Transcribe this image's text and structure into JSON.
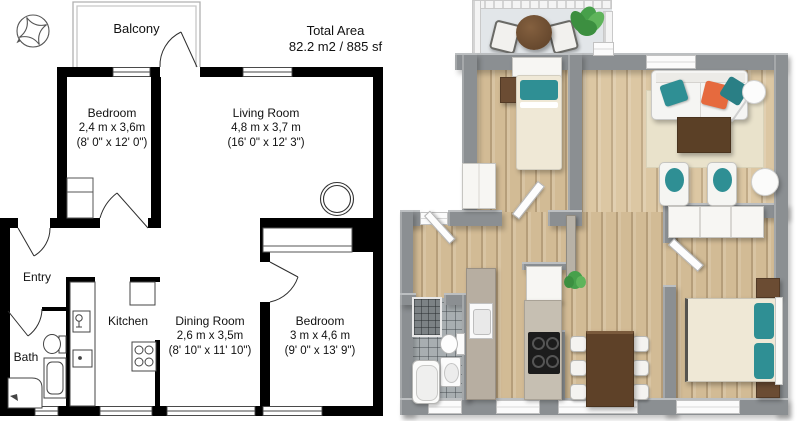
{
  "plan2d": {
    "balcony_label": "Balcony",
    "total_area_label": "Total Area",
    "total_area_value": "82.2 m2 / 885 sf",
    "rooms": {
      "bedroom1": {
        "name": "Bedroom",
        "metric": "2,4 m x 3,6m",
        "imperial": "(8' 0\" x 12' 0\")"
      },
      "living": {
        "name": "Living Room",
        "metric": "4,8 m x 3,7 m",
        "imperial": "(16' 0\" x 12' 3\")"
      },
      "entry": {
        "name": "Entry"
      },
      "bath": {
        "name": "Bath"
      },
      "kitchen": {
        "name": "Kitchen"
      },
      "dining": {
        "name": "Dining Room",
        "metric": "2,6 m x 3,5m",
        "imperial": "(8' 10\" x 11' 10\")"
      },
      "bedroom2": {
        "name": "Bedroom",
        "metric": "3 m x 4,6 m",
        "imperial": "(9' 0\" x 13' 9\")"
      }
    },
    "icons": {
      "compass": "compass-rose"
    },
    "colors": {
      "wall": "#000000",
      "background": "#ffffff",
      "balcony_outline": "#b0b0b0"
    }
  },
  "plan3d": {
    "colors": {
      "wall": "#8b8f92",
      "floor_wood": "#d2bb95",
      "floor_balcony": "#e2e6e9",
      "floor_bath": "#a8aeb1",
      "accent_teal": "#2f8f94",
      "accent_orange": "#e66a3e",
      "furniture_brown": "#6b4c33",
      "bed_cream": "#efe8d6",
      "rug": "#e9e2cb",
      "plant_green": "#47a04b"
    }
  }
}
